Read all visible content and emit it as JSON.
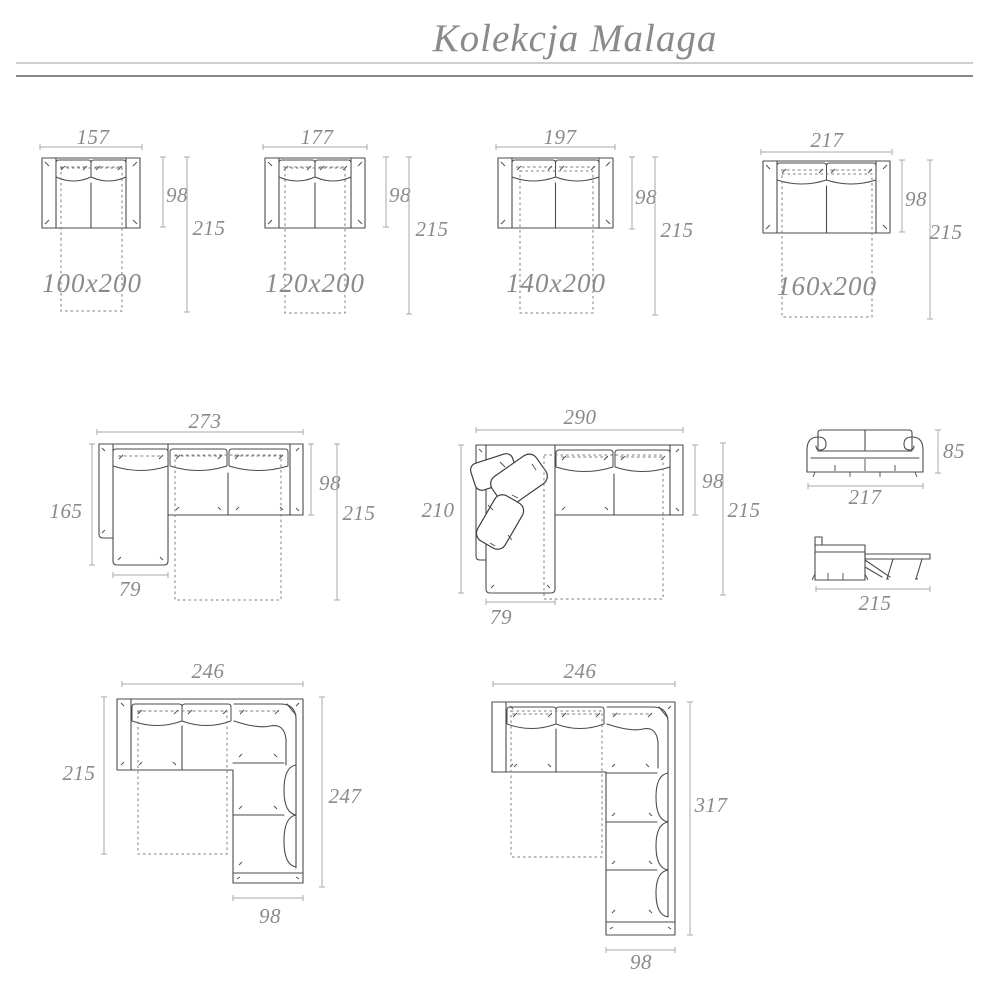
{
  "header": {
    "title": "Kolekcja Malaga"
  },
  "colors": {
    "outline": "#4b4b4b",
    "dimension_line": "#a8a8a8",
    "label_text": "#8a8a8a",
    "rule_light": "#cfcfcf",
    "rule_dark": "#8a8a8a",
    "background": "#ffffff"
  },
  "sofas": [
    {
      "name": "sofa-157",
      "width": "157",
      "depth": "98",
      "length": "215",
      "bed": "100x200"
    },
    {
      "name": "sofa-177",
      "width": "177",
      "depth": "98",
      "length": "215",
      "bed": "120x200"
    },
    {
      "name": "sofa-197",
      "width": "197",
      "depth": "98",
      "length": "215",
      "bed": "140x200"
    },
    {
      "name": "sofa-217",
      "width": "217",
      "depth": "98",
      "length": "215",
      "bed": "160x200"
    }
  ],
  "corner_sofas": [
    {
      "name": "corner-273",
      "width": "273",
      "side": "165",
      "chaise": "79",
      "depth": "98",
      "length": "215"
    },
    {
      "name": "corner-290",
      "width": "290",
      "side": "210",
      "chaise": "79",
      "depth": "98",
      "length": "215"
    }
  ],
  "front_view": {
    "width": "217",
    "height": "85"
  },
  "bed_view": {
    "length": "215"
  },
  "l_sofas": [
    {
      "name": "l-sofa-246-247",
      "width": "246",
      "side": "215",
      "leg_length": "247",
      "leg_width": "98"
    },
    {
      "name": "l-sofa-246-317",
      "width": "246",
      "leg_length": "317",
      "leg_width": "98"
    }
  ]
}
